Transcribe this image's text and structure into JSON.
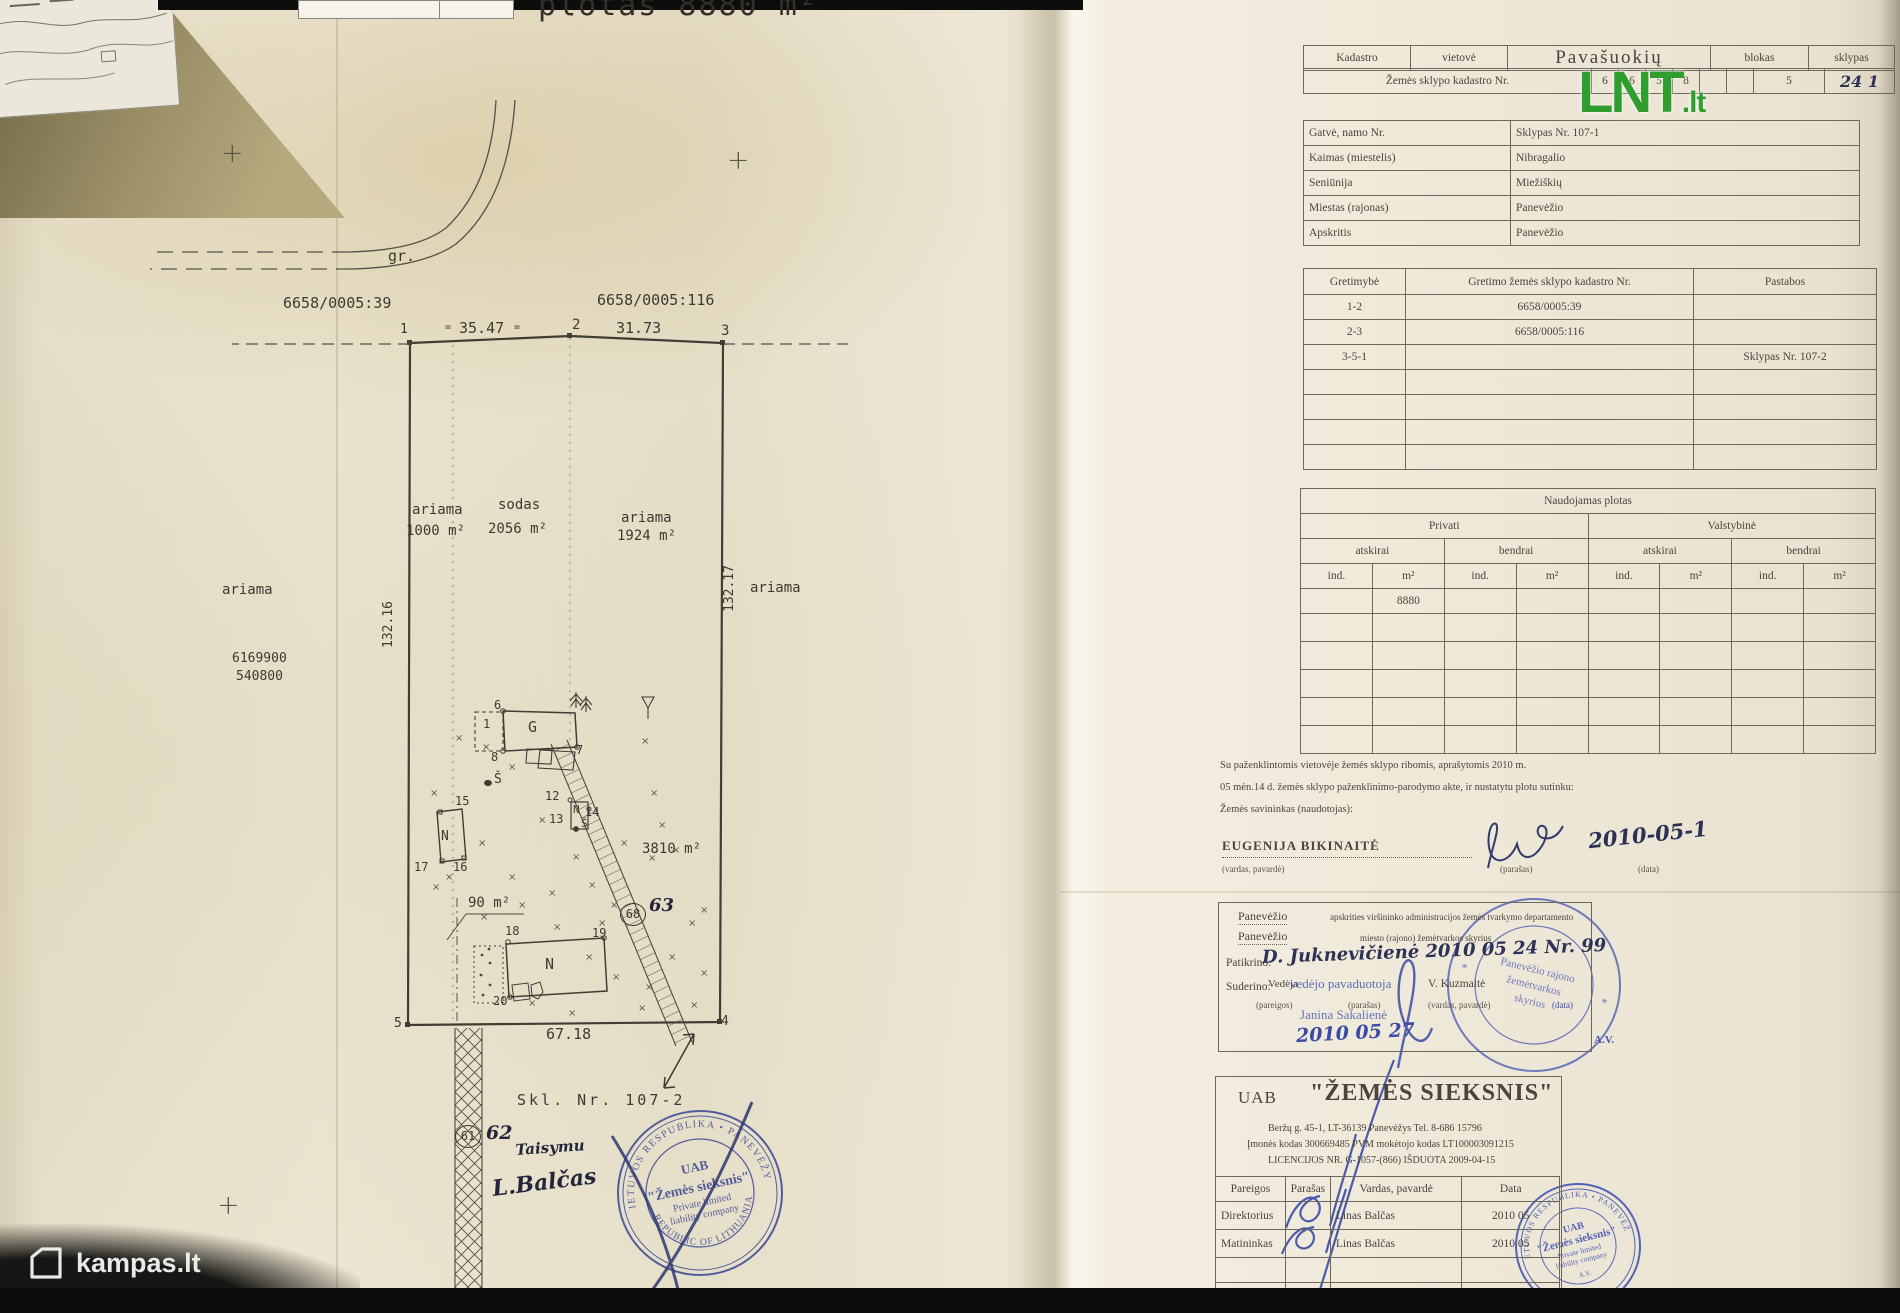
{
  "logos": {
    "lnt_main": "LNT",
    "lnt_tld": ".lt",
    "lnt_green": "#2f9e2f",
    "kampas_label": "kampas.lt"
  },
  "map": {
    "header_fragment": "plotas 8880 m²",
    "texts": [
      {
        "n": "area-total-fragment",
        "t": "plotas 8880 m²",
        "x": 538,
        "y": -12,
        "s": 30,
        "c": "frag"
      },
      {
        "n": "road-label",
        "t": "gr.",
        "x": 388,
        "y": 247,
        "s": 15
      },
      {
        "n": "parcel-left",
        "t": "6658/0005:39",
        "x": 283,
        "y": 294,
        "s": 15
      },
      {
        "n": "parcel-right",
        "t": "6658/0005:116",
        "x": 597,
        "y": 291,
        "s": 15
      },
      {
        "n": "vertex-1",
        "t": "1",
        "x": 400,
        "y": 322,
        "s": 13
      },
      {
        "n": "dist-1-2",
        "t": "35.47",
        "x": 459,
        "y": 319,
        "s": 15
      },
      {
        "n": "tick",
        "t": "=",
        "x": 445,
        "y": 322,
        "s": 10
      },
      {
        "n": "tick",
        "t": "=",
        "x": 514,
        "y": 322,
        "s": 10
      },
      {
        "n": "vertex-2",
        "t": "2",
        "x": 572,
        "y": 317,
        "s": 14
      },
      {
        "n": "dist-2-3",
        "t": "31.73",
        "x": 616,
        "y": 319,
        "s": 15
      },
      {
        "n": "vertex-3",
        "t": "3",
        "x": 721,
        "y": 323,
        "s": 14
      },
      {
        "n": "dist-west",
        "t": "132.16",
        "x": 381,
        "y": 648,
        "s": 13,
        "r": -90
      },
      {
        "n": "dist-east",
        "t": "132.17",
        "x": 722,
        "y": 612,
        "s": 13,
        "r": -90
      },
      {
        "n": "landuse",
        "t": "ariama",
        "x": 412,
        "y": 502,
        "s": 14
      },
      {
        "n": "landuse-area",
        "t": "1000 m²",
        "x": 406,
        "y": 523,
        "s": 14
      },
      {
        "n": "landuse",
        "t": "sodas",
        "x": 498,
        "y": 497,
        "s": 14
      },
      {
        "n": "landuse-area",
        "t": "2056 m²",
        "x": 488,
        "y": 521,
        "s": 14
      },
      {
        "n": "landuse",
        "t": "ariama",
        "x": 621,
        "y": 510,
        "s": 14
      },
      {
        "n": "landuse-area",
        "t": "1924 m²",
        "x": 617,
        "y": 528,
        "s": 14
      },
      {
        "n": "landuse-out",
        "t": "ariama",
        "x": 222,
        "y": 582,
        "s": 14
      },
      {
        "n": "landuse-out",
        "t": "ariama",
        "x": 750,
        "y": 580,
        "s": 14
      },
      {
        "n": "grid-north",
        "t": "6169900",
        "x": 232,
        "y": 651,
        "s": 13
      },
      {
        "n": "grid-east",
        "t": "540800",
        "x": 236,
        "y": 669,
        "s": 13
      },
      {
        "n": "bldg-1",
        "t": "1",
        "x": 483,
        "y": 717,
        "s": 12
      },
      {
        "n": "bldg-G",
        "t": "G",
        "x": 528,
        "y": 718,
        "s": 15
      },
      {
        "n": "pt-6",
        "t": "6",
        "x": 494,
        "y": 698,
        "s": 12
      },
      {
        "n": "pt-7",
        "t": "7",
        "x": 576,
        "y": 743,
        "s": 12
      },
      {
        "n": "pt-8",
        "t": "8",
        "x": 491,
        "y": 750,
        "s": 12
      },
      {
        "n": "bldg-S",
        "t": "Š",
        "x": 494,
        "y": 772,
        "s": 13
      },
      {
        "n": "pt-15",
        "t": "15",
        "x": 455,
        "y": 794,
        "s": 12
      },
      {
        "n": "bldg-N1",
        "t": "N",
        "x": 441,
        "y": 829,
        "s": 13
      },
      {
        "n": "pt-17",
        "t": "17",
        "x": 414,
        "y": 860,
        "s": 12
      },
      {
        "n": "pt-16",
        "t": "16",
        "x": 453,
        "y": 860,
        "s": 12
      },
      {
        "n": "pt-12",
        "t": "12",
        "x": 545,
        "y": 789,
        "s": 12
      },
      {
        "n": "pt-13",
        "t": "13",
        "x": 549,
        "y": 812,
        "s": 12
      },
      {
        "n": "bldg-N2",
        "t": "N",
        "x": 573,
        "y": 803,
        "s": 11
      },
      {
        "n": "pt-14",
        "t": "14",
        "x": 585,
        "y": 805,
        "s": 12
      },
      {
        "n": "well-S",
        "t": "Š",
        "x": 581,
        "y": 817,
        "s": 11
      },
      {
        "n": "area-90",
        "t": "90 m²",
        "x": 468,
        "y": 895,
        "s": 14
      },
      {
        "n": "pt-18",
        "t": "18",
        "x": 505,
        "y": 924,
        "s": 12
      },
      {
        "n": "pt-19",
        "t": "19",
        "x": 592,
        "y": 926,
        "s": 12
      },
      {
        "n": "bldg-N3",
        "t": "N",
        "x": 545,
        "y": 955,
        "s": 15
      },
      {
        "n": "pt-20",
        "t": "20",
        "x": 493,
        "y": 994,
        "s": 12
      },
      {
        "n": "area-3810",
        "t": "3810 m²",
        "x": 642,
        "y": 841,
        "s": 14
      },
      {
        "n": "vertex-5",
        "t": "5",
        "x": 394,
        "y": 1016,
        "s": 13
      },
      {
        "n": "vertex-4",
        "t": "4",
        "x": 721,
        "y": 1014,
        "s": 13
      },
      {
        "n": "dist-5-4",
        "t": "67.18",
        "x": 546,
        "y": 1025,
        "s": 15
      },
      {
        "n": "adjacent-plot",
        "t": "Skl. Nr. 107-2",
        "x": 517,
        "y": 1091,
        "s": 15,
        "c": "sp"
      },
      {
        "n": "hand-63",
        "t": "63",
        "x": 649,
        "y": 895,
        "s": 18,
        "c": "hand"
      },
      {
        "n": "hand-62",
        "t": "62",
        "x": 486,
        "y": 1122,
        "s": 19,
        "c": "hand"
      },
      {
        "n": "hand-taisymu",
        "t": "Taisymu",
        "x": 515,
        "y": 1141,
        "s": 15,
        "c": "hand",
        "r": -4
      },
      {
        "n": "hand-balcas",
        "t": "L.Balčas",
        "x": 491,
        "y": 1176,
        "s": 22,
        "c": "hand",
        "r": -7
      },
      {
        "n": "grid-cross",
        "t": "+",
        "x": 221,
        "y": 138,
        "s": 27,
        "c": "cross"
      },
      {
        "n": "grid-cross",
        "t": "+",
        "x": 727,
        "y": 145,
        "s": 27,
        "c": "cross"
      },
      {
        "n": "grid-cross",
        "t": "+",
        "x": 217,
        "y": 1190,
        "s": 27,
        "c": "cross"
      }
    ],
    "circled": [
      {
        "t": "68",
        "x": 620,
        "y": 903
      },
      {
        "t": "61",
        "x": 455,
        "y": 1125
      }
    ],
    "xmarks": [
      [
        455,
        733
      ],
      [
        508,
        762
      ],
      [
        430,
        788
      ],
      [
        478,
        838
      ],
      [
        445,
        872
      ],
      [
        508,
        872
      ],
      [
        548,
        888
      ],
      [
        588,
        880
      ],
      [
        620,
        838
      ],
      [
        648,
        853
      ],
      [
        641,
        736
      ],
      [
        650,
        788
      ],
      [
        658,
        820
      ],
      [
        672,
        845
      ],
      [
        432,
        882
      ],
      [
        518,
        900
      ],
      [
        553,
        922
      ],
      [
        585,
        952
      ],
      [
        612,
        972
      ],
      [
        645,
        982
      ],
      [
        668,
        952
      ],
      [
        638,
        1003
      ],
      [
        528,
        998
      ],
      [
        568,
        1008
      ],
      [
        598,
        918
      ],
      [
        688,
        918
      ],
      [
        700,
        968
      ],
      [
        538,
        815
      ],
      [
        572,
        852
      ],
      [
        480,
        912
      ],
      [
        700,
        905
      ],
      [
        690,
        1000
      ],
      [
        482,
        742
      ],
      [
        610,
        900
      ]
    ]
  },
  "tables": {
    "kadastro": {
      "c1": "Kadastro",
      "c2": "vietovė",
      "c3": "Pavašuokių",
      "c4": "blokas",
      "c5": "sklypas",
      "row2_label": "Žemės sklypo kadastro Nr.",
      "digits": [
        "6",
        "6",
        "5",
        "8",
        "",
        ""
      ],
      "block_digit": "5",
      "sklypas_hand": "24 1"
    },
    "location": {
      "rows": [
        [
          "Gatvė, namo Nr.",
          "Sklypas Nr. 107-1"
        ],
        [
          "Kaimas (miestelis)",
          "Nibragalio"
        ],
        [
          "Seniūnija",
          "Miežiškių"
        ],
        [
          "Miestas (rajonas)",
          "Panevėžio"
        ],
        [
          "Apskritis",
          "Panevėžio"
        ]
      ]
    },
    "gretimybe": {
      "h1": "Gretimybė",
      "h2": "Gretimo žemės sklypo kadastro Nr.",
      "h3": "Pastabos",
      "rows": [
        [
          "1-2",
          "6658/0005:39",
          ""
        ],
        [
          "2-3",
          "6658/0005:116",
          ""
        ],
        [
          "3-5-1",
          "",
          "Sklypas Nr. 107-2"
        ]
      ],
      "empty_rows": 4
    },
    "naudojimas": {
      "title": "Naudojamas plotas",
      "g1": "Privati",
      "g2": "Valstybinė",
      "s1": "atskirai",
      "s2": "bendrai",
      "col_ind": "ind.",
      "col_m2": "m²",
      "value": "8880",
      "empty_rows": 5
    }
  },
  "consent": {
    "line1": "Su paženklintomis vietovėje žemės sklypo ribomis, aprašytomis  2010 m.",
    "line2": "05 mėn.14 d. žemės sklypo paženklinimo-parodymo akte, ir nustatytu plotu sutinku:",
    "line3": "Žemės savininkas (naudotojas):",
    "owner": "EUGENIJA BIKINAITĖ",
    "cap_name": "(vardas, pavardė)",
    "cap_sig": "(parašas)",
    "cap_date": "(data)",
    "hand_date": "2010-05-1"
  },
  "approval": {
    "l1a": "Panevėžio",
    "l1b": "apskrities viršininko administracijos žemės tvarkymo departamento",
    "l2a": "Panevėžio",
    "l2b": "miesto (rajono) žemėtvarkos skyrius",
    "patikrino": "Patikrino:",
    "patikrino_hand": "D. Juknevičienė      2010 05 24  Nr. 99",
    "suderino": "Suderino:",
    "vedeja": "Vedėja",
    "stamp_role": "vedėjo pavaduotoja",
    "name": "V. Kuzmaitė",
    "cap1": "(pareigos)",
    "cap2": "(parašas)",
    "cap3": "(vardas, pavardė)",
    "cap4": "(data)",
    "blue_name": "Janina Sakalienė",
    "blue_date": "2010 05 27",
    "av": "A.V."
  },
  "gov_stamp": {
    "l1": "Panevėžio rajono",
    "l2": "žemėtvarkos",
    "l3": "skyrius"
  },
  "company": {
    "uab": "UAB",
    "name": "\"ŽEMĖS SIEKSNIS\"",
    "addr": "Beržų g. 45-1, LT-36139 Panevėžys Tel. 8-686 15796",
    "codes": "Įmonės kodas 300669485   PVM mokėtojo kodas LT100003091215",
    "lic": "LICENCIJOS NR. G-1057-(866) IŠDUOTA 2009-04-15",
    "h1": "Pareigos",
    "h2": "Parašas",
    "h3": "Vardas, pavardė",
    "h4": "Data",
    "rows": [
      [
        "Direktorius",
        "Linas Balčas",
        "2010 05"
      ],
      [
        "Matininkas",
        "Linas Balčas",
        "2010 05"
      ]
    ],
    "empty_rows": 2
  },
  "company_stamp": {
    "uab": "UAB",
    "name": "\"Žemės sieksnis\"",
    "l3": "Private limited",
    "l4": "liability company",
    "ring_top": "LIETUVOS RESPUBLIKA • PANEVĖŽYS",
    "ring_bottom": "REPUBLIC OF LITHUANIA",
    "av": "A.V."
  }
}
